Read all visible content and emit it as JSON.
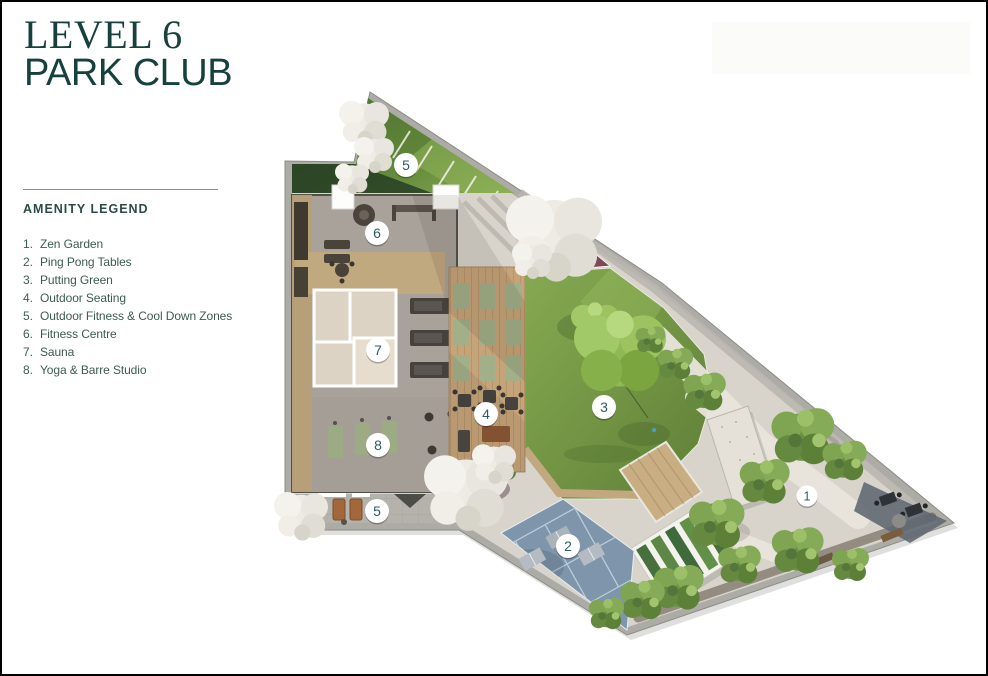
{
  "header": {
    "title_line1": "LEVEL 6",
    "title_line2": "PARK CLUB"
  },
  "legend": {
    "heading": "AMENITY LEGEND",
    "items": [
      {
        "number": "1.",
        "label": "Zen Garden"
      },
      {
        "number": "2.",
        "label": "Ping Pong Tables"
      },
      {
        "number": "3.",
        "label": "Putting Green"
      },
      {
        "number": "4.",
        "label": "Outdoor Seating"
      },
      {
        "number": "5.",
        "label": "Outdoor Fitness & Cool Down Zones"
      },
      {
        "number": "6.",
        "label": "Fitness Centre"
      },
      {
        "number": "7.",
        "label": "Sauna"
      },
      {
        "number": "8.",
        "label": "Yoga & Barre Studio"
      }
    ]
  },
  "plan": {
    "markers": [
      {
        "label": "1",
        "x": 805,
        "y": 494,
        "r": 10.5
      },
      {
        "label": "2",
        "x": 566,
        "y": 544,
        "r": 12
      },
      {
        "label": "3",
        "x": 602,
        "y": 405,
        "r": 12
      },
      {
        "label": "4",
        "x": 484,
        "y": 412,
        "r": 12
      },
      {
        "label": "5",
        "x": 404,
        "y": 163,
        "r": 12
      },
      {
        "label": "5",
        "x": 375,
        "y": 509,
        "r": 12
      },
      {
        "label": "6",
        "x": 375,
        "y": 231,
        "r": 12
      },
      {
        "label": "7",
        "x": 376,
        "y": 348,
        "r": 12
      },
      {
        "label": "8",
        "x": 376,
        "y": 443,
        "r": 12
      }
    ]
  },
  "colors": {
    "title": "#16413c",
    "legend_heading": "#2b4c46",
    "legend_text": "#3d5b54",
    "rule": "#7c948d",
    "marker_number": "#2e5c63",
    "lawn_green": "#6f923f",
    "court_blue": "#7e95ab",
    "deck_wood": "#c6a47a",
    "paving": "#d8d4cb"
  }
}
